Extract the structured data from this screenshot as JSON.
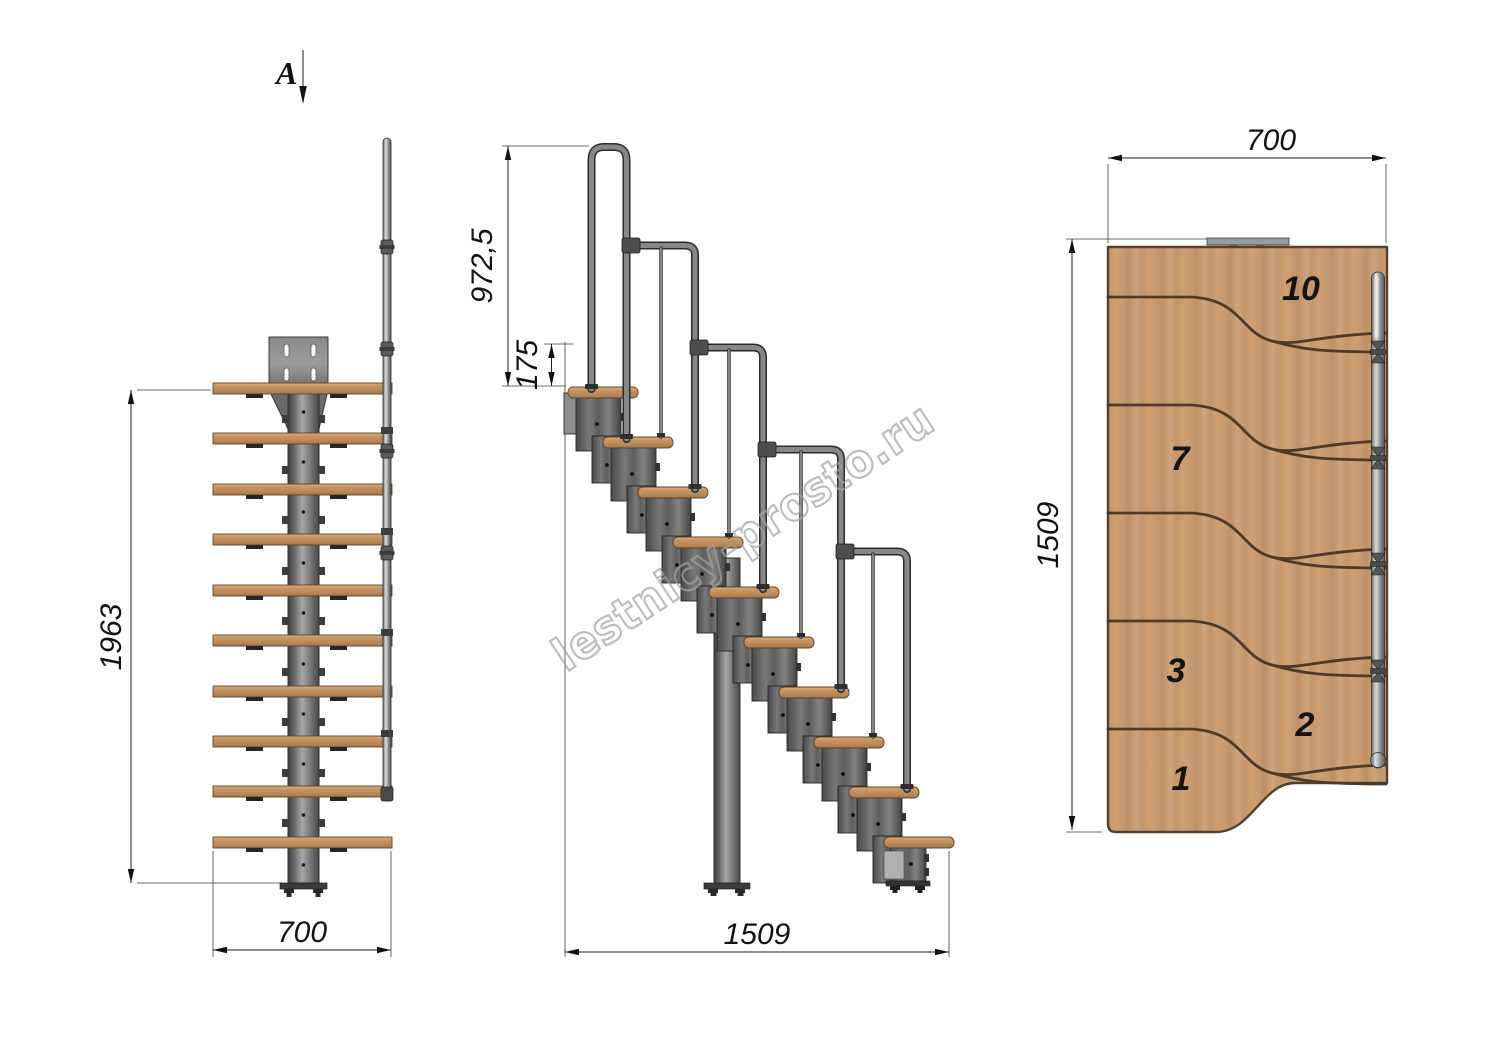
{
  "drawing": {
    "view_label": "A",
    "watermark": "lestnicy-prosto.ru",
    "front_view": {
      "height": "1963",
      "width": "700"
    },
    "side_view": {
      "handrail_height": "972,5",
      "rise": "175",
      "length": "1509"
    },
    "top_view": {
      "width": "700",
      "depth": "1509",
      "step_numbers": {
        "s10": "10",
        "s7": "7",
        "s3": "3",
        "s2": "2",
        "s1": "1"
      }
    },
    "colors": {
      "background": "#ffffff",
      "wood": "#c49a72",
      "wood_edge": "#5f4429",
      "metal": "#6f6f6f",
      "metal_dark": "#2e2e2e",
      "dimension_line": "#1d1d1d",
      "watermark_gray": "#a3a3a3"
    }
  }
}
